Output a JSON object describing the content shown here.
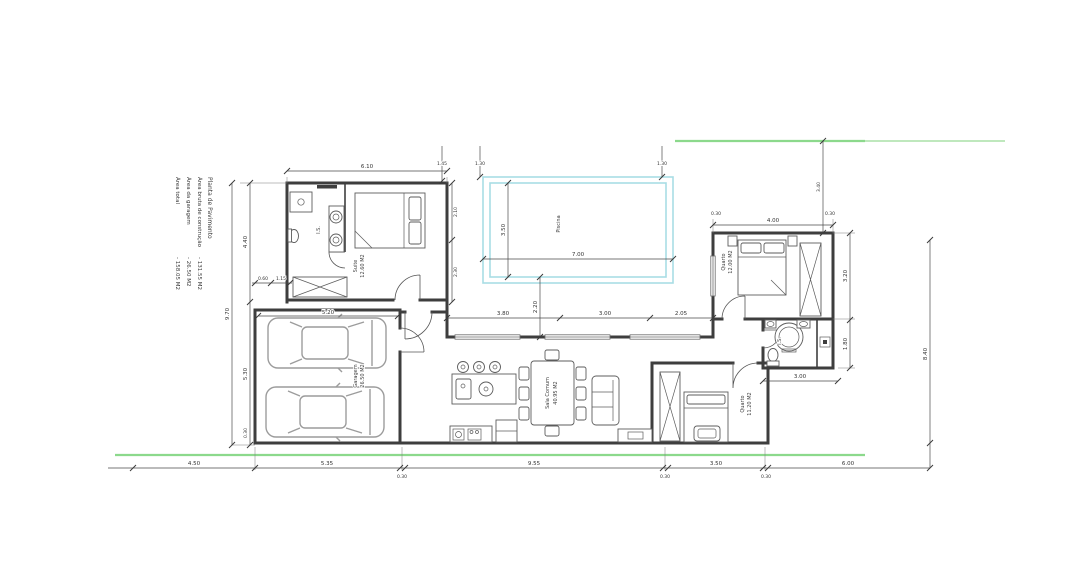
{
  "legend": {
    "title": "Planta de Pavimento",
    "items": [
      {
        "label": "Área bruta de construção",
        "value": "- 131.55 M2"
      },
      {
        "label": "Área da garagem",
        "value": "- 26.50 M2"
      },
      {
        "label": "Área total",
        "value": "- 158.05 M2"
      }
    ]
  },
  "rooms": {
    "suite": {
      "name": "Suite",
      "area": "12.60 M2"
    },
    "suite_bath": {
      "name": "I.S."
    },
    "garage": {
      "name": "Garagem",
      "area": "26.50 M2"
    },
    "living": {
      "name": "Sala Comum",
      "area": "40.95 M2"
    },
    "bedroom_right": {
      "name": "Quarto",
      "area": "12.00 M2"
    },
    "bedroom_bottom": {
      "name": "Quarto",
      "area": "11.20 M2"
    },
    "bathroom_right": {
      "name": "I.S."
    },
    "pool": {
      "name": "Piscina"
    }
  },
  "dimensions": {
    "suite_top": "6.10",
    "garage_top": "5.20",
    "left_outer": "9.70",
    "left_inner_top": "4.40",
    "left_inner_bottom": "5.30",
    "left_small": "0.30",
    "suite_small_1": "0.60",
    "suite_small_2": "1.15",
    "suite_right_top": "2.10",
    "suite_right_bottom": "2.30",
    "setback_1": "1.45",
    "setback_2": "1.30",
    "setback_3": "1.30",
    "setback_right": "3.40",
    "pool_width": "7.00",
    "pool_height": "3.50",
    "pool_gap": "2.20",
    "courtyard_1": "3.80",
    "courtyard_2": "3.00",
    "courtyard_3": "2.05",
    "bedroom_top": "4.00",
    "bedroom_top_s1": "0.30",
    "bedroom_top_s2": "0.30",
    "right_inner_top": "3.20",
    "right_inner_bottom": "1.80",
    "right_outer": "8.40",
    "bath_width": "3.00",
    "bottom_1": "4.50",
    "bottom_2": "5.35",
    "bottom_3": "0.30",
    "bottom_4": "9.55",
    "bottom_5": "0.30",
    "bottom_6": "3.50",
    "bottom_7": "0.30",
    "bottom_8": "6.00"
  },
  "colors": {
    "site_boundary_green": "#8cd98c",
    "pool_cyan": "#a8dde4",
    "walls": "#3e3e3e",
    "cars": "#9c9c9c",
    "dimension_lines": "#4a4a4a"
  }
}
